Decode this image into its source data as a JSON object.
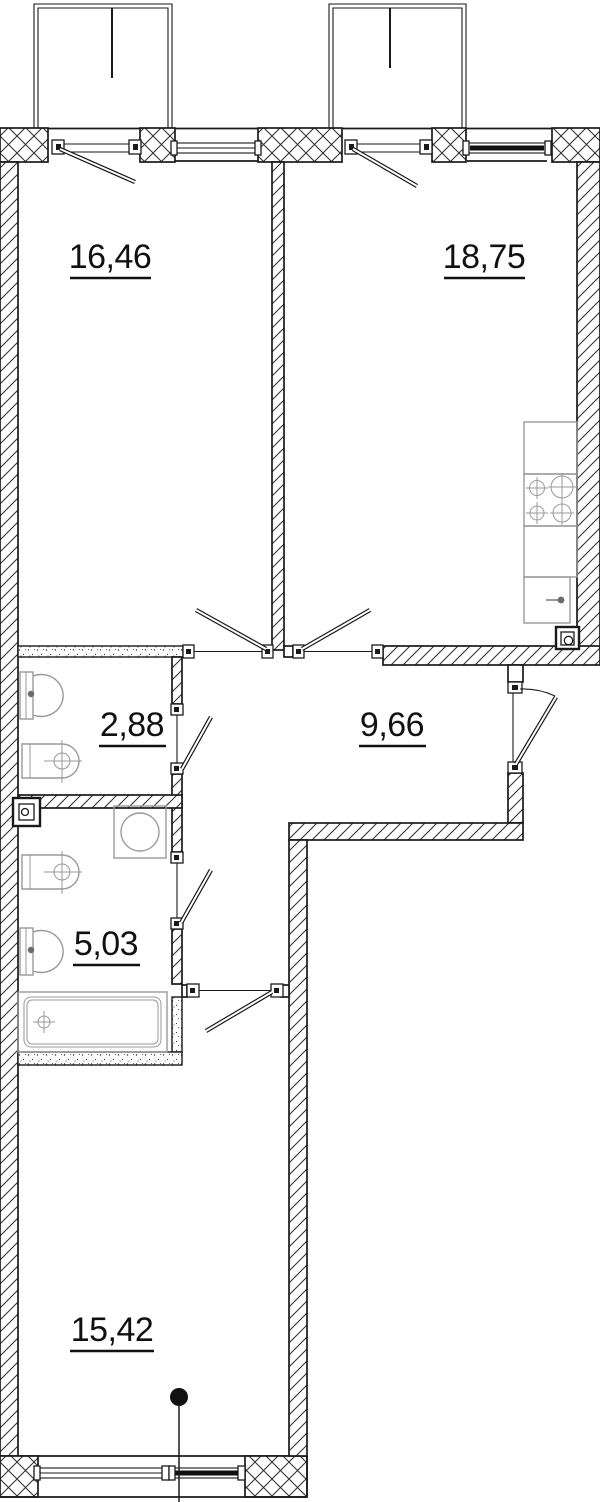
{
  "plan": {
    "title": "apartment-floor-plan",
    "rooms": [
      {
        "id": "room-1",
        "area": "16,46"
      },
      {
        "id": "room-2",
        "area": "18,75"
      },
      {
        "id": "wc",
        "area": "2,88"
      },
      {
        "id": "hallway",
        "area": "9,66"
      },
      {
        "id": "bathroom",
        "area": "5,03"
      },
      {
        "id": "room-3",
        "area": "15,42"
      }
    ],
    "fixtures": [
      "stove-burners-symbol",
      "kitchen-sink-symbol",
      "kitchen-counter",
      "vent-shaft-icon",
      "toilet-symbol",
      "wash-basin-symbol",
      "washing-machine-symbol",
      "bathtub-symbol",
      "section-marker-dot"
    ],
    "colors": {
      "wall_line": "#1a1a1a",
      "fixture_line": "#9a9a9a",
      "background": "#ffffff"
    }
  }
}
